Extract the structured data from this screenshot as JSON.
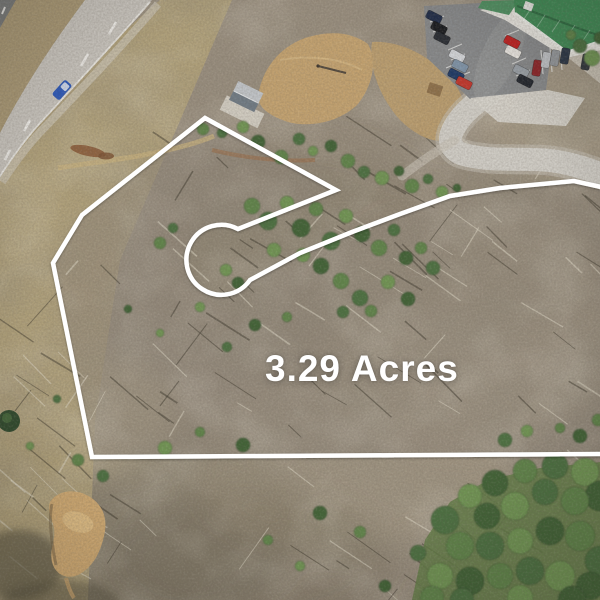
{
  "annotation": {
    "acreage_label": "3.29 Acres",
    "boundary_color": "#ffffff",
    "boundary_stroke_width": 4.5,
    "boundary_path": "M 601 187 L 574 181 L 500 188 L 450 196 L 400 214 L 352 232 L 300 253 L 250 280 A 35 35 0 1 1 238 229 L 336 190 L 205 118 L 82 215 L 53 263 L 92 457 L 601 454",
    "parcel_fill_path": "M 601 187 L 574 181 L 500 188 L 450 196 L 400 214 L 352 232 L 300 253 L 250 280 A 35 35 0 1 1 238 229 L 336 190 L 205 118 L 82 215 L 53 263 L 92 457 L 601 454 Z",
    "cul_de_sac": {
      "cx": 221,
      "cy": 261,
      "r": 35
    }
  },
  "scene": {
    "features": [
      "divided-highway-top-left",
      "blue-car-on-highway",
      "grass-median",
      "roadside-shed-gray-roof",
      "tan-dirt-clearing",
      "utility-pole",
      "gravel-driveway",
      "green-metal-roof-building",
      "parking-lot-with-cars",
      "cutover-timber-parcel",
      "fallen-log-streaks",
      "scattered-pine-trees",
      "cul-de-sac-keyhole-easement",
      "sand-erosion-patch",
      "dense-tree-canopy-bottom-right"
    ],
    "palette": {
      "scrub_ground": "#9a8f7f",
      "grass": "#b3a37b",
      "dirt_clearing": "#c7a470",
      "highway_pavement": "#cbc7c0",
      "gravel_road": "#d3d0c9",
      "parking_asphalt": "#87898b",
      "roof_green": "#3f8a55",
      "tree_green": "#5f8449",
      "sand": "#d4ad74",
      "boundary_white": "#ffffff"
    },
    "trees": [
      [
        203,
        129,
        6
      ],
      [
        222,
        133,
        5
      ],
      [
        243,
        127,
        6
      ],
      [
        258,
        142,
        7
      ],
      [
        281,
        157,
        7
      ],
      [
        299,
        139,
        6
      ],
      [
        313,
        151,
        5
      ],
      [
        331,
        146,
        6
      ],
      [
        348,
        161,
        7
      ],
      [
        364,
        172,
        6
      ],
      [
        382,
        178,
        7
      ],
      [
        399,
        171,
        5
      ],
      [
        412,
        186,
        7
      ],
      [
        428,
        179,
        5
      ],
      [
        442,
        192,
        6
      ],
      [
        457,
        188,
        4
      ],
      [
        252,
        206,
        8
      ],
      [
        268,
        221,
        9
      ],
      [
        287,
        203,
        7
      ],
      [
        301,
        228,
        9
      ],
      [
        316,
        209,
        7
      ],
      [
        331,
        241,
        9
      ],
      [
        346,
        216,
        7
      ],
      [
        362,
        234,
        8
      ],
      [
        379,
        248,
        8
      ],
      [
        394,
        230,
        6
      ],
      [
        303,
        255,
        7
      ],
      [
        321,
        266,
        8
      ],
      [
        341,
        281,
        8
      ],
      [
        360,
        298,
        8
      ],
      [
        274,
        250,
        7
      ],
      [
        406,
        258,
        7
      ],
      [
        421,
        248,
        6
      ],
      [
        433,
        268,
        7
      ],
      [
        388,
        282,
        7
      ],
      [
        408,
        299,
        7
      ],
      [
        371,
        311,
        6
      ],
      [
        343,
        312,
        6
      ],
      [
        226,
        270,
        6
      ],
      [
        238,
        283,
        6
      ],
      [
        160,
        243,
        6
      ],
      [
        173,
        228,
        5
      ],
      [
        200,
        307,
        5
      ],
      [
        255,
        325,
        6
      ],
      [
        287,
        317,
        5
      ],
      [
        227,
        347,
        5
      ],
      [
        160,
        333,
        4
      ],
      [
        128,
        309,
        4
      ],
      [
        78,
        460,
        6
      ],
      [
        103,
        476,
        6
      ],
      [
        165,
        448,
        7
      ],
      [
        243,
        445,
        7
      ],
      [
        200,
        432,
        5
      ],
      [
        57,
        399,
        4
      ],
      [
        30,
        446,
        4
      ],
      [
        320,
        513,
        7
      ],
      [
        360,
        532,
        6
      ],
      [
        418,
        553,
        8
      ],
      [
        300,
        566,
        5
      ],
      [
        385,
        586,
        6
      ],
      [
        268,
        540,
        5
      ],
      [
        505,
        440,
        7
      ],
      [
        527,
        431,
        6
      ],
      [
        580,
        436,
        7
      ],
      [
        560,
        428,
        5
      ],
      [
        580,
        46,
        7
      ],
      [
        592,
        58,
        8
      ],
      [
        600,
        38,
        6
      ],
      [
        571,
        35,
        5
      ],
      [
        445,
        520,
        14
      ],
      [
        470,
        496,
        12
      ],
      [
        495,
        483,
        13
      ],
      [
        525,
        471,
        12
      ],
      [
        555,
        466,
        13
      ],
      [
        585,
        472,
        14
      ],
      [
        600,
        496,
        15
      ],
      [
        575,
        501,
        14
      ],
      [
        545,
        492,
        13
      ],
      [
        515,
        506,
        14
      ],
      [
        487,
        516,
        13
      ],
      [
        460,
        546,
        14
      ],
      [
        490,
        546,
        14
      ],
      [
        520,
        541,
        13
      ],
      [
        550,
        531,
        14
      ],
      [
        580,
        536,
        15
      ],
      [
        600,
        561,
        15
      ],
      [
        440,
        576,
        13
      ],
      [
        470,
        581,
        14
      ],
      [
        500,
        576,
        13
      ],
      [
        530,
        571,
        14
      ],
      [
        560,
        576,
        15
      ],
      [
        590,
        586,
        14
      ],
      [
        432,
        598,
        12
      ],
      [
        462,
        600,
        12
      ],
      [
        520,
        598,
        13
      ],
      [
        572,
        600,
        14
      ],
      [
        598,
        420,
        6
      ]
    ],
    "parked_cars": [
      [
        434,
        17,
        27,
        "#1e2b47"
      ],
      [
        439,
        28,
        27,
        "#17191d"
      ],
      [
        442,
        38,
        27,
        "#262a31"
      ],
      [
        457,
        56,
        27,
        "#d3d6da"
      ],
      [
        460,
        66,
        27,
        "#7e93a8"
      ],
      [
        456,
        75,
        27,
        "#1c3764"
      ],
      [
        464,
        83,
        27,
        "#c2342a"
      ],
      [
        512,
        42,
        27,
        "#c01f1f"
      ],
      [
        513,
        52,
        27,
        "#ece9e4"
      ],
      [
        521,
        71,
        27,
        "#9aa1a8"
      ],
      [
        525,
        81,
        27,
        "#20242c"
      ],
      [
        537,
        68,
        100,
        "#8c2327"
      ],
      [
        546,
        60,
        100,
        "#c0c3c7"
      ],
      [
        555,
        58,
        100,
        "#94989c"
      ],
      [
        565,
        56,
        100,
        "#2a3545"
      ],
      [
        586,
        62,
        100,
        "#30353c"
      ]
    ],
    "highway_vehicle": {
      "x": 62,
      "y": 90,
      "rot": 132,
      "color": "#2b58bb"
    }
  }
}
